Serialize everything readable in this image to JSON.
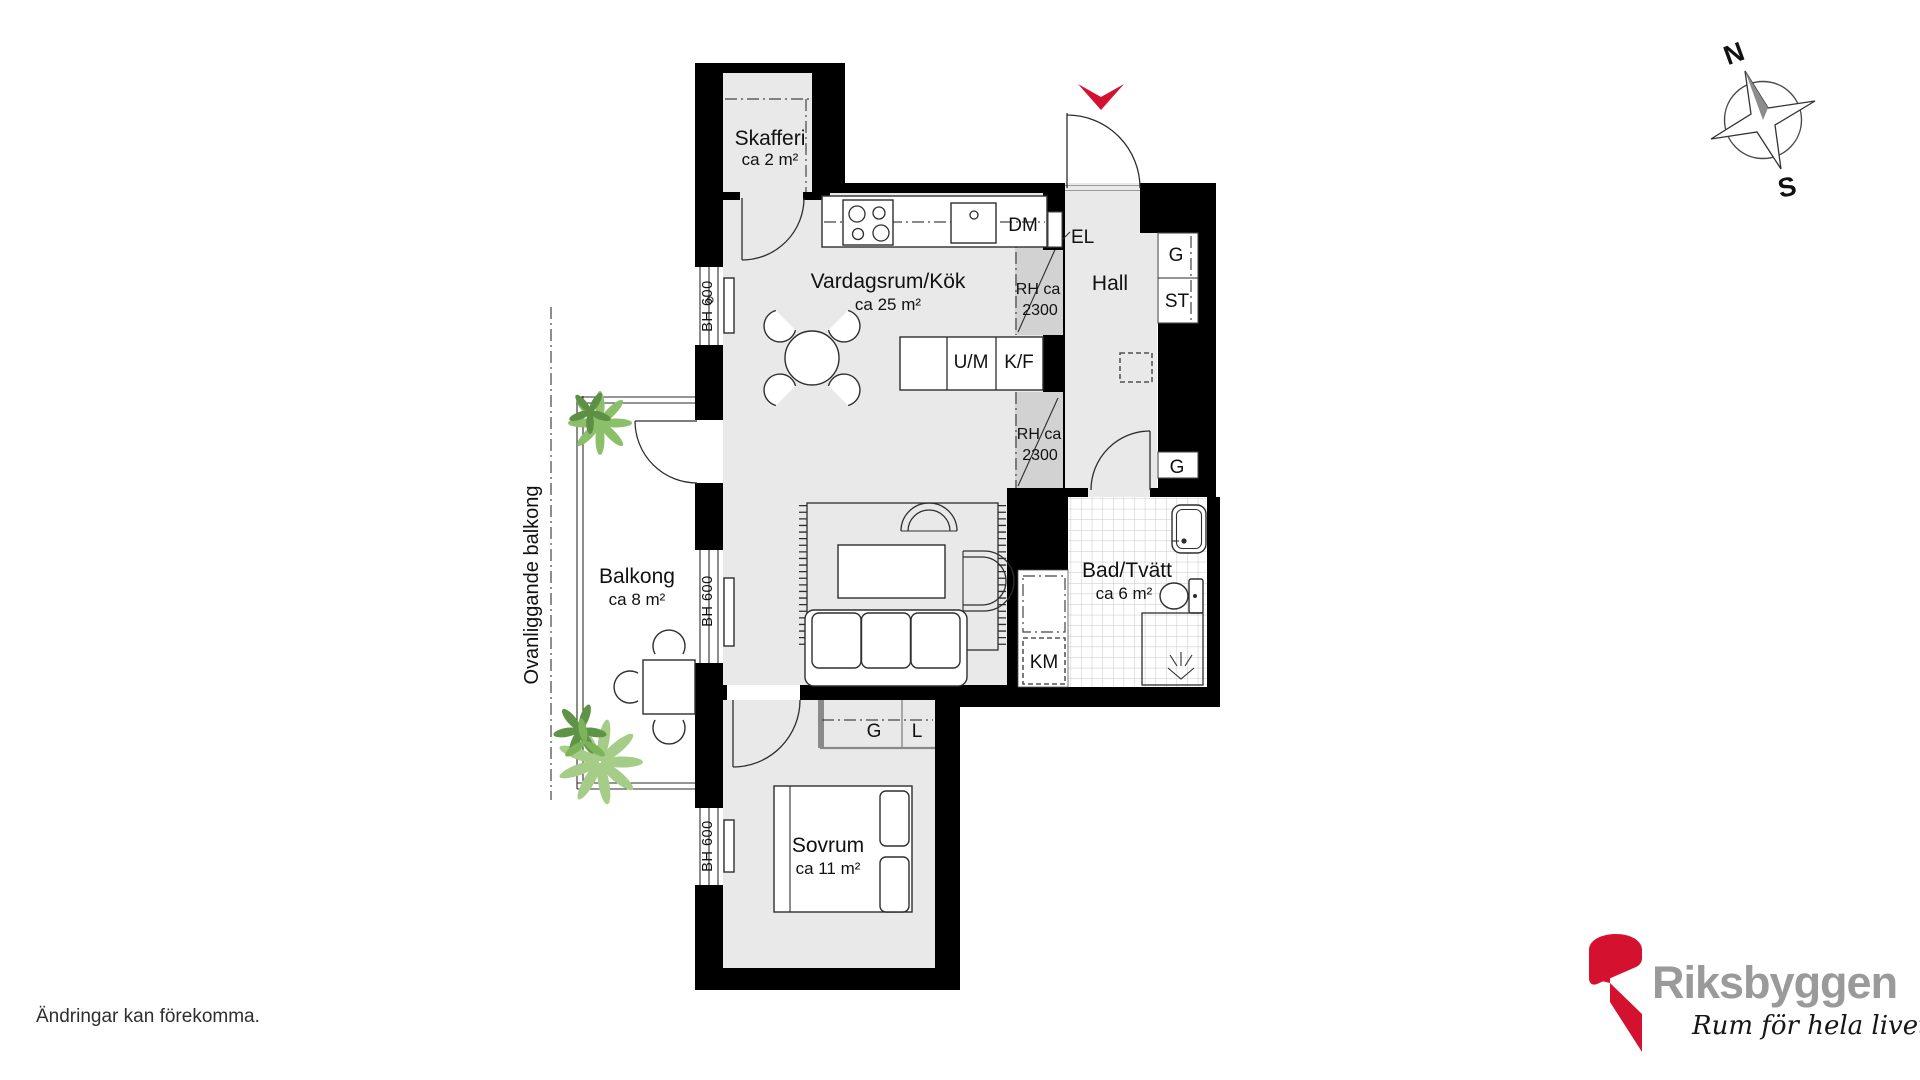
{
  "plan": {
    "rooms": {
      "skafferi": {
        "name": "Skafferi",
        "area": "ca 2 m²"
      },
      "vardagsrum": {
        "name": "Vardagsrum/Kök",
        "area": "ca 25 m²"
      },
      "hall": {
        "name": "Hall"
      },
      "balkong": {
        "name": "Balkong",
        "area": "ca 8 m²"
      },
      "bad": {
        "name": "Bad/Tvätt",
        "area": "ca 6 m²"
      },
      "sovrum": {
        "name": "Sovrum",
        "area": "ca 11 m²"
      }
    },
    "labels": {
      "dm": "DM",
      "el": "EL",
      "g": "G",
      "st": "ST",
      "um": "U/M",
      "kf": "K/F",
      "km": "KM",
      "l": "L",
      "rh1": "RH ca",
      "rh2": "2300",
      "bh600": "BH 600",
      "ovanliggande": "Ovanliggande balkong"
    },
    "compass": {
      "n": "N",
      "s": "S"
    }
  },
  "footer": {
    "disclaimer": "Ändringar kan förekomma."
  },
  "brand": {
    "name": "Riksbyggen",
    "tagline": "Rum för hela livet"
  },
  "colors": {
    "accent_red": "#d51130",
    "logo_gray": "#9a9a9a",
    "wall_black": "#000000",
    "room_fill": "#e9e9e9",
    "rh_fill": "#d2d2d2",
    "plant_green": "#7cb454",
    "tile_line": "#c6c6c6"
  }
}
